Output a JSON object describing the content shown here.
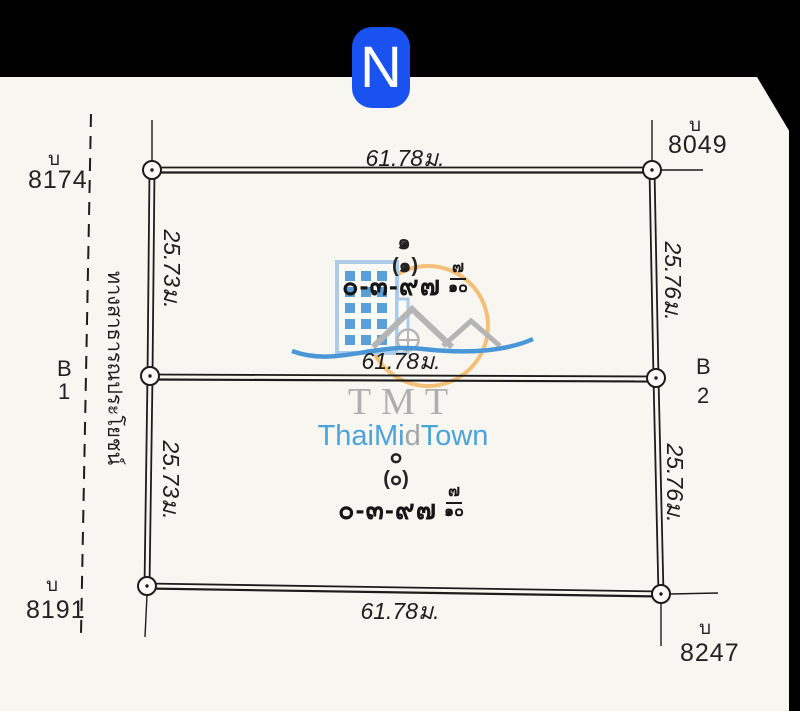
{
  "page": {
    "background": "#f8f6f1",
    "ink": "#1c1c1c",
    "bar_color": "#000000"
  },
  "north_badge": {
    "letter": "N",
    "background": "#1a52f2",
    "letter_color": "#ffffff"
  },
  "road": {
    "label": "ทางสาธารณประโยชน์"
  },
  "boundary_markers": {
    "top_left": {
      "prefix": "บ",
      "number": "8174"
    },
    "top_right": {
      "prefix": "บ",
      "number": "8049"
    },
    "middle_left": {
      "prefix": "B",
      "number": "1"
    },
    "middle_right": {
      "prefix": "B",
      "number": "2"
    },
    "bottom_left": {
      "prefix": "บ",
      "number": "8191"
    },
    "bottom_right": {
      "prefix": "บ",
      "number": "8247"
    }
  },
  "dimensions": {
    "top_width": "61.78ม.",
    "middle_width": "61.78ม.",
    "bottom_width": "61.78ม.",
    "upper_left_depth": "25.73ม.",
    "lower_left_depth": "25.73ม.",
    "upper_right_depth": "25.76ม.",
    "lower_right_depth": "25.76ม."
  },
  "parcels": {
    "upper": {
      "sequence": "๑",
      "sequence_paren": "(๑)",
      "area_rai": "๐-๓-๙๗",
      "area_fraction_numerator": "๗",
      "area_fraction_denominator": "๑๐"
    },
    "lower": {
      "sequence": "๐",
      "sequence_paren": "(๐)",
      "area_rai": "๐-๓-๙๗",
      "area_fraction_numerator": "๗",
      "area_fraction_denominator": "๑๐"
    }
  },
  "watermark": {
    "abbr": "TMT",
    "abbr_color": "#aeaeae",
    "name": [
      {
        "text": "ThaiMi",
        "color": "#4ba3da"
      },
      {
        "text": "d",
        "color": "#a2a7aa"
      },
      {
        "text": "Town",
        "color": "#4ba3da"
      }
    ],
    "building_outline": "#abcbe9",
    "window_color": "#5b9fd6",
    "circle_color": "#f4c077",
    "roof_color": "#b5b5b5",
    "wave_color": "#4a97d8"
  }
}
